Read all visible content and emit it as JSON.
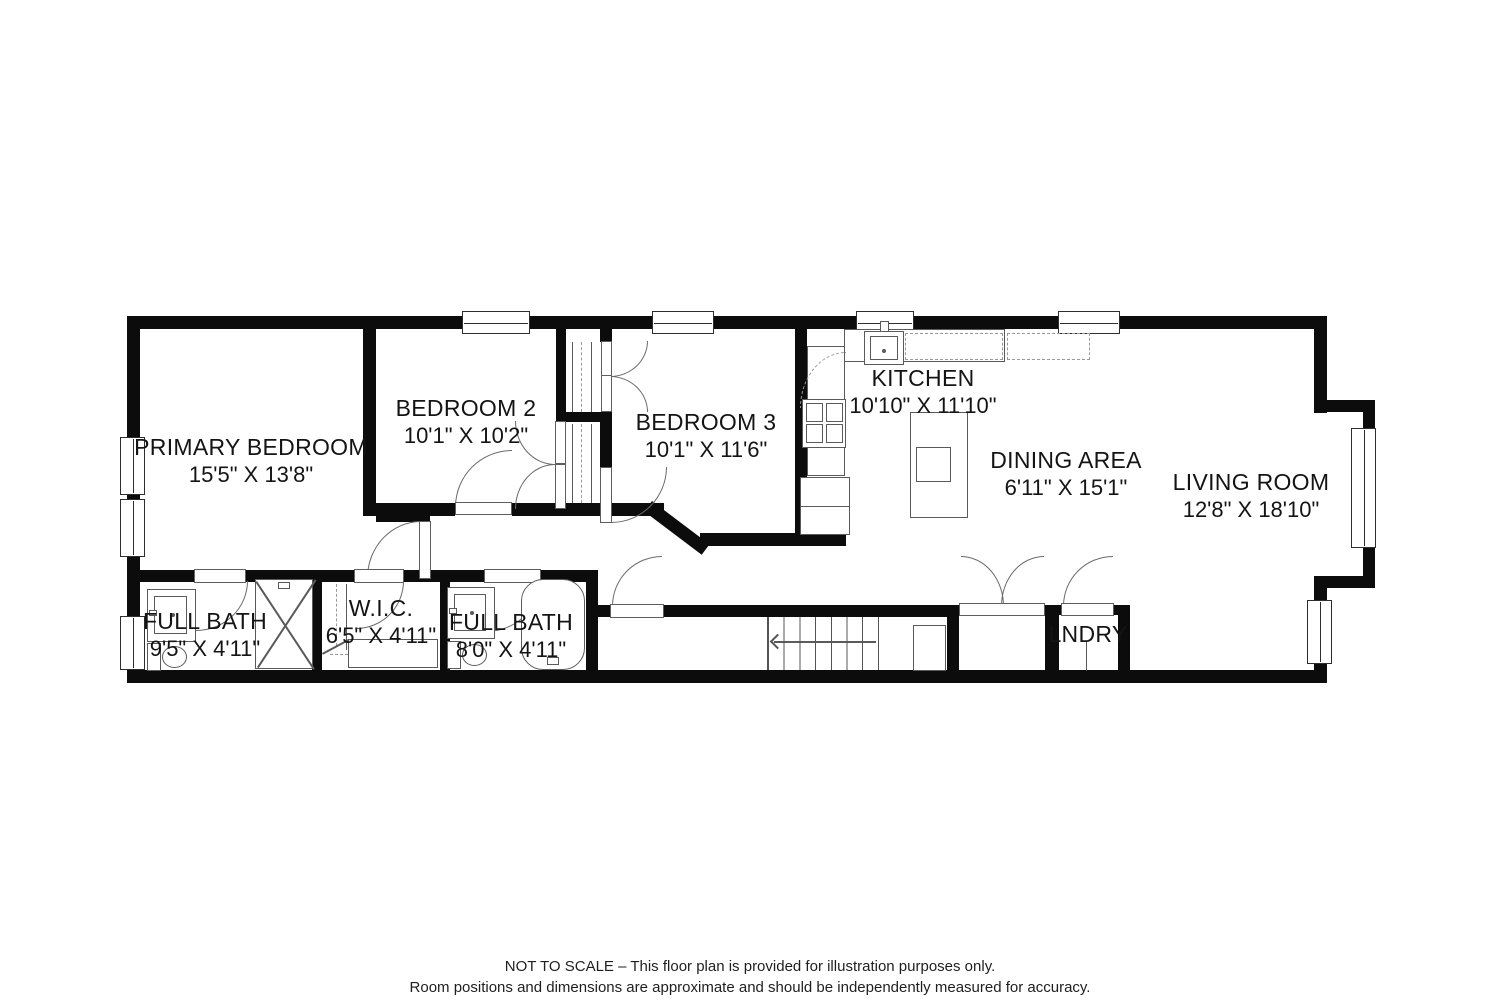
{
  "colors": {
    "wall": "#0c0c0c",
    "fixture_line": "#5a5a5a",
    "text": "#141414",
    "background": "#ffffff"
  },
  "rooms": [
    {
      "name": "PRIMARY BEDROOM",
      "dimensions": "15'5\" X 13'8\""
    },
    {
      "name": "BEDROOM 2",
      "dimensions": "10'1\" X 10'2\""
    },
    {
      "name": "BEDROOM 3",
      "dimensions": "10'1\" X 11'6\""
    },
    {
      "name": "KITCHEN",
      "dimensions": "10'10\" X 11'10\""
    },
    {
      "name": "DINING AREA",
      "dimensions": "6'11\" X 15'1\""
    },
    {
      "name": "LIVING ROOM",
      "dimensions": "12'8\" X 18'10\""
    },
    {
      "name": "FULL BATH",
      "dimensions": "9'5\" X 4'11\""
    },
    {
      "name": "W.I.C.",
      "dimensions": "6'5\" X 4'11\""
    },
    {
      "name": "FULL BATH",
      "dimensions": "8'0\" X 4'11\""
    },
    {
      "name": "LNDRY",
      "dimensions": ""
    }
  ],
  "footer": {
    "line1": "NOT TO SCALE – This floor plan is provided for illustration purposes only.",
    "line2": "Room positions and dimensions are approximate and should be independently measured for accuracy."
  }
}
